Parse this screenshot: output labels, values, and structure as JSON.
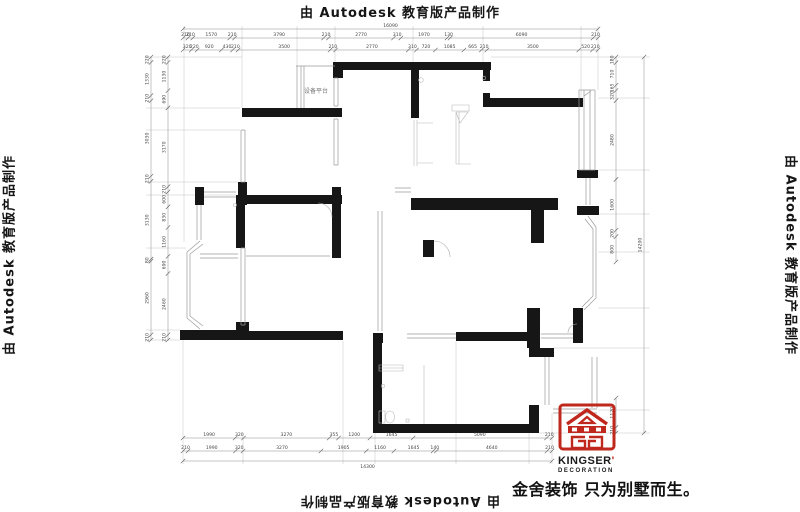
{
  "watermark": {
    "text": "由 Autodesk 教育版产品制作"
  },
  "plan": {
    "platform_label": "设备平台"
  },
  "branding": {
    "name": "KINGSER",
    "apostrophe": "'",
    "subtitle": "DECORATION",
    "slogan": "金舍装饰 只为别墅而生。"
  },
  "colors": {
    "wall": "#161616",
    "brand_red": "#c0281e",
    "dim_text": "#444444",
    "line_light": "#9a9a9a"
  },
  "dimensions": {
    "top": {
      "total": [
        "16090"
      ],
      "row1": [
        "210",
        "210",
        "1570",
        "210",
        "3790",
        "210",
        "2770",
        "310",
        "1970",
        "130",
        "6090",
        "210"
      ],
      "row2": [
        "320",
        "220",
        "920",
        "430",
        "210",
        "3500",
        "210",
        "2770",
        "310",
        "720",
        "1085",
        "665",
        "210",
        "3500",
        "520",
        "210"
      ]
    },
    "bottom": {
      "row1": [
        "1990",
        "320",
        "3270",
        "355",
        "1200",
        "1645",
        "5090",
        "210"
      ],
      "row2": [
        "210",
        "1990",
        "320",
        "3270",
        "1905",
        "1160",
        "1645",
        "140",
        "4640",
        "210"
      ],
      "total": [
        "14300"
      ]
    },
    "left": {
      "outer": [
        "220",
        "1330",
        "210",
        "3030",
        "210",
        "3130",
        "80",
        "2960",
        "210"
      ],
      "inner": [
        "220",
        "1130",
        "690",
        "3170",
        "210",
        "600",
        "830",
        "1160",
        "690",
        "2460",
        "210"
      ]
    },
    "right": {
      "inner": [
        "180",
        "710",
        "165",
        "320",
        "2480",
        "1600",
        "200",
        "800"
      ],
      "lower": [
        "1120",
        "210"
      ],
      "outer": [
        "14200"
      ]
    }
  }
}
